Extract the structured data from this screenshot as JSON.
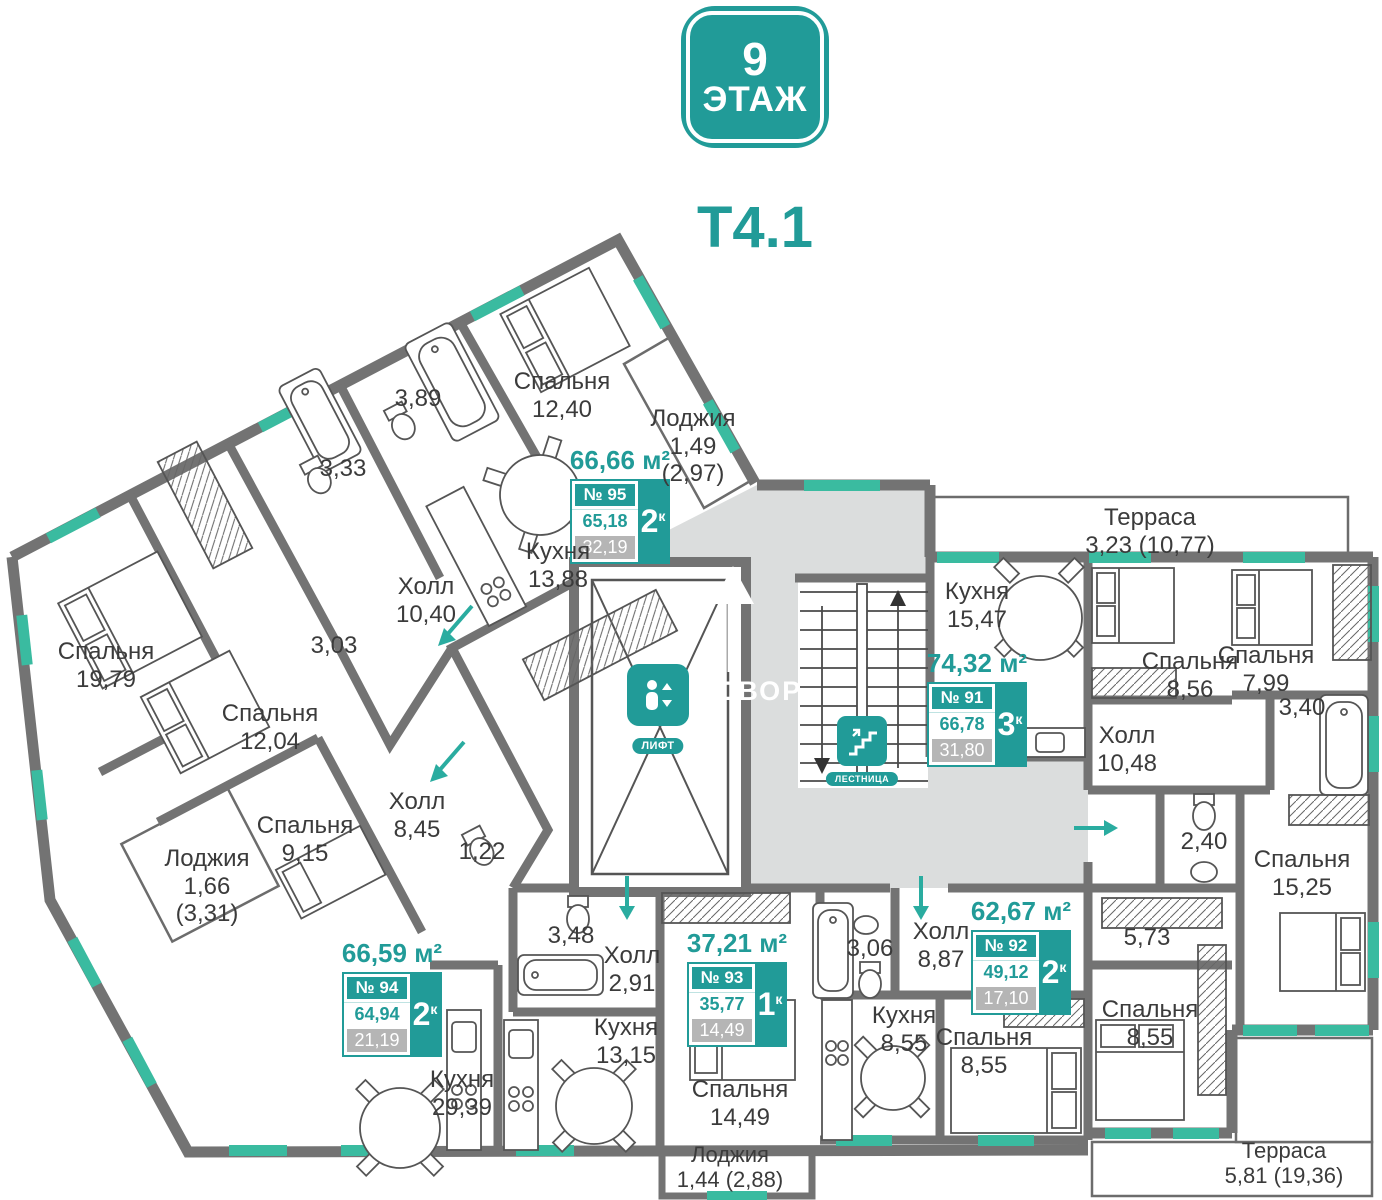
{
  "header": {
    "floor_number": "9",
    "floor_word": "ЭТАЖ",
    "section": "Т4.1"
  },
  "colors": {
    "accent": "#219B98",
    "window": "#3ABBA0",
    "wall": "#737373",
    "common_area": "#DBDDDD",
    "value_gray": "#B5B5B5"
  },
  "common": {
    "courtyard": "ВО ДВОР",
    "lift": "ЛИФТ",
    "stairs": "ЛЕСТНИЦА"
  },
  "apartments": [
    {
      "area_total": "66,66 м²",
      "number": "№ 95",
      "rooms": "2",
      "rooms_suffix": "к",
      "area_living": "65,18",
      "area_extra": "32,19"
    },
    {
      "area_total": "74,32 м²",
      "number": "№ 91",
      "rooms": "3",
      "rooms_suffix": "к",
      "area_living": "66,78",
      "area_extra": "31,80"
    },
    {
      "area_total": "62,67 м²",
      "number": "№ 92",
      "rooms": "2",
      "rooms_suffix": "к",
      "area_living": "49,12",
      "area_extra": "17,10"
    },
    {
      "area_total": "37,21 м²",
      "number": "№ 93",
      "rooms": "1",
      "rooms_suffix": "к",
      "area_living": "35,77",
      "area_extra": "14,49"
    },
    {
      "area_total": "66,59 м²",
      "number": "№ 94",
      "rooms": "2",
      "rooms_suffix": "к",
      "area_living": "64,94",
      "area_extra": "21,19"
    }
  ],
  "rooms": [
    {
      "name": "Спальня",
      "area": "12,40"
    },
    {
      "name": "",
      "area": "3,89"
    },
    {
      "name": "",
      "area": "3,33"
    },
    {
      "name": "Лоджия",
      "area": "1,49",
      "area2": "(2,97)"
    },
    {
      "name": "Кухня",
      "area": "13,88"
    },
    {
      "name": "Холл",
      "area": "10,40"
    },
    {
      "name": "Спальня",
      "area": "19,79"
    },
    {
      "name": "",
      "area": "3,03"
    },
    {
      "name": "Спальня",
      "area": "12,04"
    },
    {
      "name": "Спальня",
      "area": "9,15"
    },
    {
      "name": "Лоджия",
      "area": "1,66",
      "area2": "(3,31)"
    },
    {
      "name": "Холл",
      "area": "8,45"
    },
    {
      "name": "",
      "area": "1,22"
    },
    {
      "name": "Кухня",
      "area": "29,39"
    },
    {
      "name": "",
      "area": "3,48"
    },
    {
      "name": "Холл",
      "area": "2,91"
    },
    {
      "name": "Кухня",
      "area": "13,15"
    },
    {
      "name": "Спальня",
      "area": "14,49"
    },
    {
      "name": "Лоджия",
      "area": "1,44 (2,88)"
    },
    {
      "name": "",
      "area": "3,06"
    },
    {
      "name": "Холл",
      "area": "8,87"
    },
    {
      "name": "Кухня",
      "area": "8,55"
    },
    {
      "name": "Спальня",
      "area": "8,55"
    },
    {
      "name": "Кухня",
      "area": "15,47"
    },
    {
      "name": "Спальня",
      "area": "8,56"
    },
    {
      "name": "Спальня",
      "area": "7,99"
    },
    {
      "name": "Терраса",
      "area": "3,23 (10,77)"
    },
    {
      "name": "Холл",
      "area": "10,48"
    },
    {
      "name": "",
      "area": "3,40"
    },
    {
      "name": "",
      "area": "2,40"
    },
    {
      "name": "Спальня",
      "area": "15,25"
    },
    {
      "name": "",
      "area": "5,73"
    },
    {
      "name": "Спальня",
      "area": "8,55"
    },
    {
      "name": "Терраса",
      "area": "5,81 (19,36)"
    }
  ]
}
